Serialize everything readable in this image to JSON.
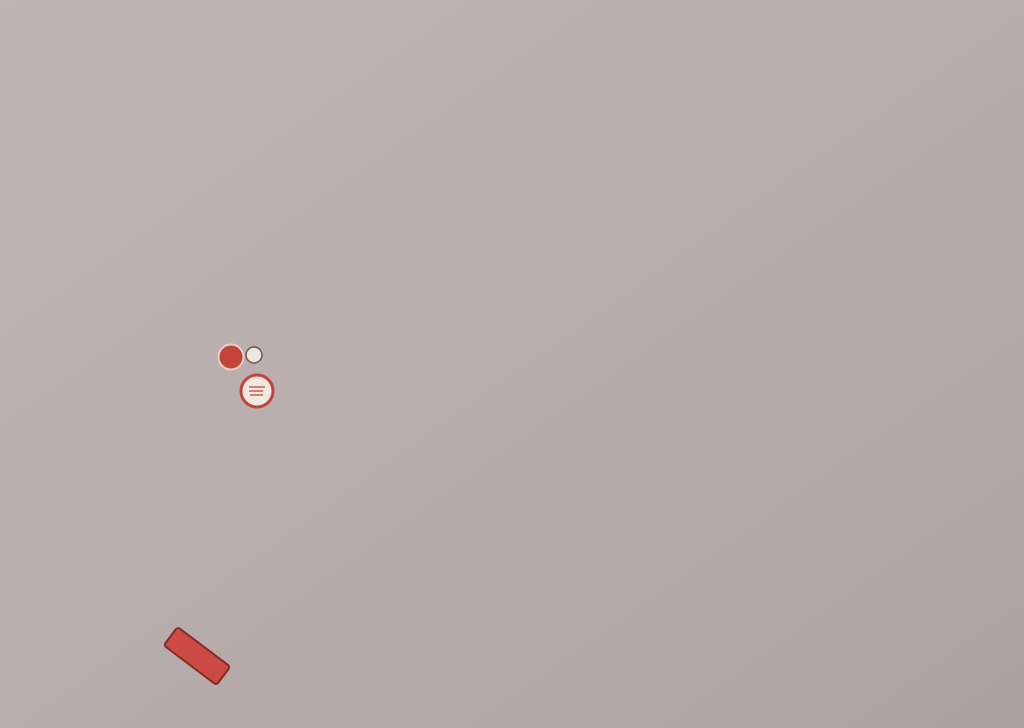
{
  "legend": {
    "items_left": [
      "1. Oficina de Turismo",
      "2. Plaza de la Constitución",
      "3. Ayuntamiento",
      "4. Calle Mirador",
      "5. Miradores",
      "6. Iglesia de Santa María",
      "7. Casa del Marqués del Carpio",
      "8. Teatro Villaespesa",
      "9. Casa del Duque de Alba",
      "10. Ermita de San Roque",
      "11. Casa del Duque de Valoig"
    ],
    "items_right": [
      "12. Ermita de Fátima",
      "13. Hornos Árabes",
      "14. Talleres Alfareros",
      "15. Fuente de los Caños",
      "16. Parque",
      "17. Plaza de Abastos",
      "18. Piscina Municipal",
      "19. Centro de Salud",
      "20. Correos",
      "21. Centro de Interpretación",
      "Karst en yesos"
    ]
  },
  "map": {
    "river_label": "RIO AGUAS",
    "signs": {
      "road_sign": "N-340a",
      "route_marker": "2",
      "info_marker": "1"
    },
    "street_labels": [
      {
        "name": "street-label-san-francisco",
        "text": "San Francisco",
        "x": 357,
        "y": 136,
        "rot": 48,
        "size": 9.5
      },
      {
        "name": "street-label-gonzalez-ros",
        "text": "González Ros",
        "x": 438,
        "y": 148,
        "rot": 12,
        "size": 9.5
      },
      {
        "name": "street-label-c-de-la-cuesta",
        "text": "C. de la Cuesta",
        "x": 277,
        "y": 156,
        "rot": 52,
        "size": 9
      },
      {
        "name": "street-label-andalucia",
        "text": "Andalucía",
        "x": 368,
        "y": 256,
        "rot": 36,
        "size": 9.5
      },
      {
        "name": "street-label-c-san-jose",
        "text": "C. San José",
        "x": 416,
        "y": 308,
        "rot": 9,
        "size": 9
      },
      {
        "name": "street-label-pedro-alvarez",
        "text": "Pedro Álvarez",
        "x": 534,
        "y": 220,
        "rot": 42,
        "size": 9.5
      },
      {
        "name": "street-label-tomas-valera",
        "text": "Tomás Valera",
        "x": 580,
        "y": 306,
        "rot": 5,
        "size": 9.5
      },
      {
        "name": "street-label-terraplen",
        "text": "Terraplén",
        "x": 256,
        "y": 342,
        "rot": 83,
        "size": 9
      }
    ],
    "markers": [
      {
        "t": "5",
        "x": 417,
        "y": 52
      },
      {
        "t": "15",
        "x": 551,
        "y": 46
      },
      {
        "t": "5",
        "x": 263,
        "y": 125
      },
      {
        "t": "8",
        "x": 310,
        "y": 153
      },
      {
        "t": "6",
        "x": 403,
        "y": 217
      },
      {
        "t": "2",
        "x": 446,
        "y": 223,
        "big": true
      },
      {
        "t": "7",
        "x": 465,
        "y": 234
      },
      {
        "t": "3",
        "x": 415,
        "y": 257
      },
      {
        "t": "11",
        "x": 435,
        "y": 268
      },
      {
        "t": "16",
        "x": 273,
        "y": 305
      },
      {
        "t": "4",
        "x": 610,
        "y": 193
      },
      {
        "t": "5",
        "x": 511,
        "y": 310
      },
      {
        "t": "10",
        "x": 770,
        "y": 217
      },
      {
        "t": "13",
        "x": 872,
        "y": 67
      },
      {
        "t": "14",
        "x": 838,
        "y": 84
      },
      {
        "t": "5",
        "x": 649,
        "y": 392
      },
      {
        "t": "5",
        "x": 263,
        "y": 549
      },
      {
        "t": "12",
        "x": 573,
        "y": 502
      }
    ],
    "circled_markers": [
      {
        "t": "17",
        "x": 419,
        "y": 272
      },
      {
        "t": "20",
        "x": 648,
        "y": 298
      }
    ],
    "boxed_markers": [
      {
        "t": "21",
        "x": 260,
        "y": 228
      }
    ],
    "colors": {
      "river": "#2d7fc2",
      "road": "#4f9bcb",
      "ochre": "#d9a63f",
      "ochre_dark": "#bd861f",
      "building": "#b05529",
      "roof": "#a34a65",
      "green": "#5f9c33",
      "legend_text": "#9e291d",
      "marker_red": "#c3362b",
      "rail_dark": "#20201e"
    }
  }
}
